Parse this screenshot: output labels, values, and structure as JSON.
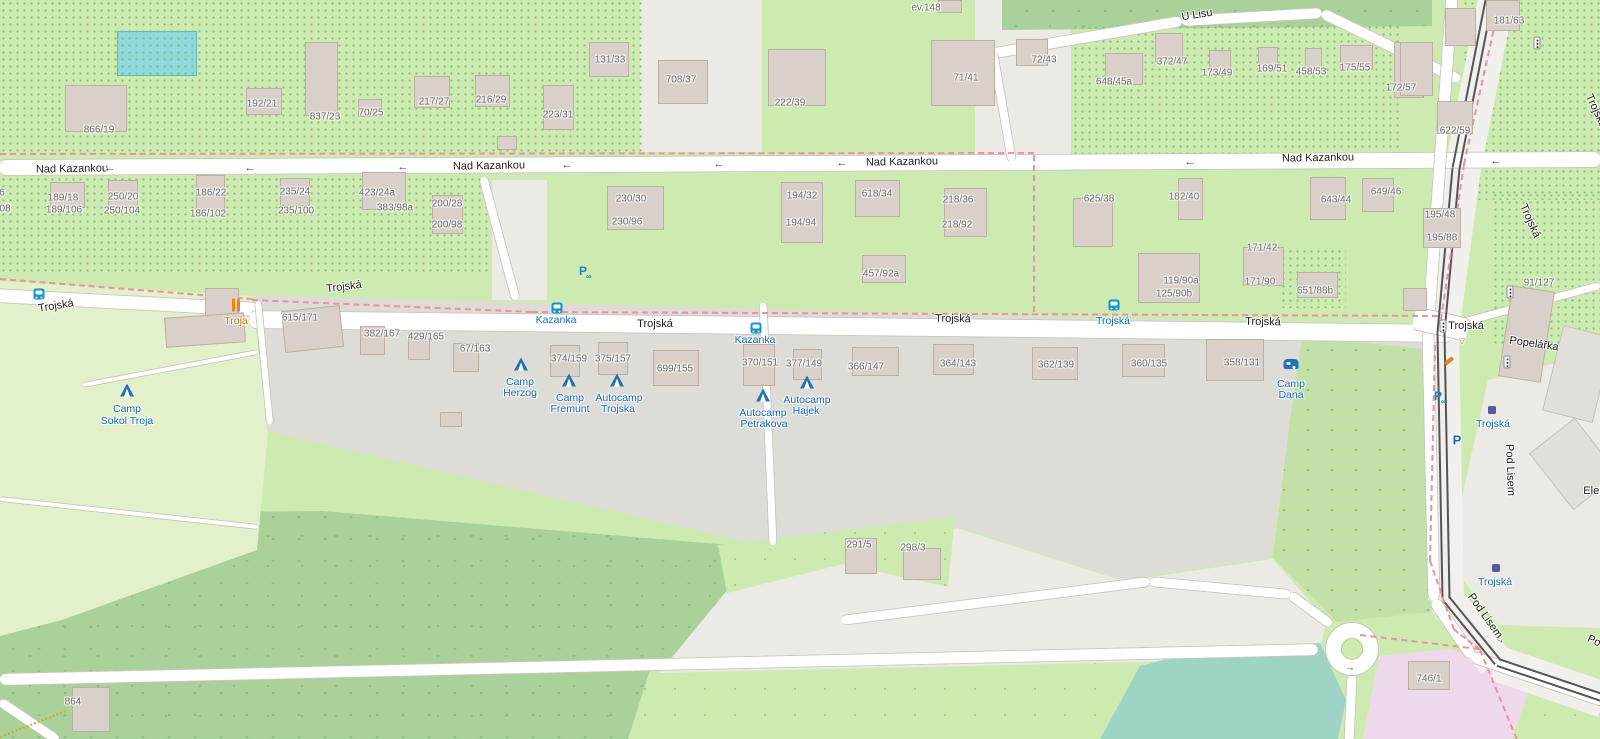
{
  "app": "slippy-map-viewport",
  "colors": {
    "grass": "#cdebb0",
    "camp_area": "#e2f1cb",
    "forest": "#a9d199",
    "scrub": "#c2e0a8",
    "residential_gray": "#dedcd7",
    "paved": "#eceae5",
    "road": "#ffffff",
    "road_casing": "#cac5bb",
    "building": "#d9d0c9",
    "building_border": "#bbb0a2",
    "water": "#9ed4c6",
    "pool": "#8ed8de",
    "pink_zone": "#eed9ec",
    "boundary_dash": "#ef8f9f",
    "path_dotted": "#d9a62e",
    "transit_blue": "#0f70b7",
    "tourism_blue": "#1269c4",
    "restaurant_orange": "#ef8413",
    "tram_line": "#555555",
    "street_label": "#1d1d1d",
    "house_label": "#6b6b6b"
  },
  "street_labels": [
    {
      "text": "Nad Kazankou",
      "x": 72,
      "y": 169,
      "rot": -1
    },
    {
      "text": "Nad Kazankou",
      "x": 489,
      "y": 166,
      "rot": -1
    },
    {
      "text": "Nad Kazankou",
      "x": 902,
      "y": 162,
      "rot": -1
    },
    {
      "text": "Nad Kazankou",
      "x": 1318,
      "y": 158,
      "rot": -1
    },
    {
      "text": "U Lisu",
      "x": 1197,
      "y": 15,
      "rot": -9
    },
    {
      "text": "Trojská",
      "x": 56,
      "y": 306,
      "rot": -9
    },
    {
      "text": "Trojská",
      "x": 344,
      "y": 287,
      "rot": -7
    },
    {
      "text": "Trojská",
      "x": 655,
      "y": 324,
      "rot": 0
    },
    {
      "text": "Trojská",
      "x": 953,
      "y": 319,
      "rot": 1
    },
    {
      "text": "Trojská",
      "x": 1263,
      "y": 322,
      "rot": 1
    },
    {
      "text": "Trojská",
      "x": 1466,
      "y": 326,
      "rot": 0
    },
    {
      "text": "Trojská",
      "x": 1596,
      "y": 111,
      "rot": 65
    },
    {
      "text": "Trojská",
      "x": 1530,
      "y": 221,
      "rot": 66
    },
    {
      "text": "Pod Lisem",
      "x": 1510,
      "y": 470,
      "rot": 88
    },
    {
      "text": "Pod Lisem",
      "x": 1485,
      "y": 616,
      "rot": 55
    },
    {
      "text": "Popelářka",
      "x": 1534,
      "y": 344,
      "rot": 8
    },
    {
      "text": "Elek",
      "x": 1594,
      "y": 491,
      "rot": 0
    },
    {
      "text": "Po",
      "x": 1594,
      "y": 641,
      "rot": 25
    }
  ],
  "house_numbers": [
    {
      "text": "866/19",
      "x": 99,
      "y": 130
    },
    {
      "text": "192/21",
      "x": 262,
      "y": 104
    },
    {
      "text": "837/23",
      "x": 325,
      "y": 117
    },
    {
      "text": "70/25",
      "x": 371,
      "y": 113
    },
    {
      "text": "217/27",
      "x": 434,
      "y": 102
    },
    {
      "text": "216/29",
      "x": 491,
      "y": 100
    },
    {
      "text": "223/31",
      "x": 558,
      "y": 115
    },
    {
      "text": "131/33",
      "x": 610,
      "y": 60
    },
    {
      "text": "708/37",
      "x": 681,
      "y": 80
    },
    {
      "text": "222/39",
      "x": 790,
      "y": 103
    },
    {
      "text": "71/41",
      "x": 966,
      "y": 78
    },
    {
      "text": "ev.148",
      "x": 926,
      "y": 8
    },
    {
      "text": "72/43",
      "x": 1044,
      "y": 60
    },
    {
      "text": "648/45a",
      "x": 1114,
      "y": 82
    },
    {
      "text": "372/47",
      "x": 1172,
      "y": 62
    },
    {
      "text": "173/49",
      "x": 1217,
      "y": 73
    },
    {
      "text": "169/51",
      "x": 1272,
      "y": 69
    },
    {
      "text": "458/53",
      "x": 1311,
      "y": 72
    },
    {
      "text": "175/55",
      "x": 1355,
      "y": 68
    },
    {
      "text": "172/57",
      "x": 1401,
      "y": 88
    },
    {
      "text": "181/63",
      "x": 1509,
      "y": 21
    },
    {
      "text": "622/59",
      "x": 1455,
      "y": 131
    },
    {
      "text": "6",
      "x": 2,
      "y": 193
    },
    {
      "text": "08",
      "x": 5,
      "y": 209
    },
    {
      "text": "189/18",
      "x": 63,
      "y": 198
    },
    {
      "text": "189/106",
      "x": 64,
      "y": 210
    },
    {
      "text": "250/20",
      "x": 123,
      "y": 197
    },
    {
      "text": "250/104",
      "x": 122,
      "y": 211
    },
    {
      "text": "186/22",
      "x": 211,
      "y": 193
    },
    {
      "text": "186/102",
      "x": 208,
      "y": 214
    },
    {
      "text": "235/24",
      "x": 295,
      "y": 192
    },
    {
      "text": "235/100",
      "x": 296,
      "y": 211
    },
    {
      "text": "423/24a",
      "x": 377,
      "y": 193
    },
    {
      "text": "383/98a",
      "x": 395,
      "y": 208
    },
    {
      "text": "200/28",
      "x": 447,
      "y": 204
    },
    {
      "text": "200/98",
      "x": 447,
      "y": 225
    },
    {
      "text": "230/30",
      "x": 631,
      "y": 199
    },
    {
      "text": "230/96",
      "x": 627,
      "y": 222
    },
    {
      "text": "194/32",
      "x": 802,
      "y": 196
    },
    {
      "text": "194/94",
      "x": 801,
      "y": 223
    },
    {
      "text": "618/34",
      "x": 877,
      "y": 194
    },
    {
      "text": "218/36",
      "x": 958,
      "y": 200
    },
    {
      "text": "218/92",
      "x": 957,
      "y": 225
    },
    {
      "text": "457/92a",
      "x": 881,
      "y": 274
    },
    {
      "text": "625/38",
      "x": 1099,
      "y": 199
    },
    {
      "text": "182/40",
      "x": 1184,
      "y": 197
    },
    {
      "text": "643/44",
      "x": 1336,
      "y": 200
    },
    {
      "text": "649/46",
      "x": 1386,
      "y": 192
    },
    {
      "text": "195/48",
      "x": 1440,
      "y": 215
    },
    {
      "text": "195/88",
      "x": 1442,
      "y": 238
    },
    {
      "text": "171/42",
      "x": 1262,
      "y": 248
    },
    {
      "text": "171/90",
      "x": 1260,
      "y": 282
    },
    {
      "text": "119/90a",
      "x": 1181,
      "y": 281
    },
    {
      "text": "125/90b",
      "x": 1174,
      "y": 294
    },
    {
      "text": "651/88b",
      "x": 1315,
      "y": 291
    },
    {
      "text": "91/127",
      "x": 1539,
      "y": 283
    },
    {
      "text": "615/171",
      "x": 300,
      "y": 318
    },
    {
      "text": "382/167",
      "x": 382,
      "y": 334
    },
    {
      "text": "429/165",
      "x": 426,
      "y": 337
    },
    {
      "text": "67/163",
      "x": 475,
      "y": 349
    },
    {
      "text": "374/159",
      "x": 569,
      "y": 359
    },
    {
      "text": "375/157",
      "x": 613,
      "y": 359
    },
    {
      "text": "699/155",
      "x": 675,
      "y": 369
    },
    {
      "text": "370/151",
      "x": 760,
      "y": 363
    },
    {
      "text": "377/149",
      "x": 804,
      "y": 364
    },
    {
      "text": "366/147",
      "x": 866,
      "y": 367
    },
    {
      "text": "364/143",
      "x": 958,
      "y": 364
    },
    {
      "text": "362/139",
      "x": 1056,
      "y": 365
    },
    {
      "text": "360/135",
      "x": 1149,
      "y": 364
    },
    {
      "text": "358/131",
      "x": 1242,
      "y": 363
    },
    {
      "text": "291/5",
      "x": 859,
      "y": 545
    },
    {
      "text": "298/3",
      "x": 913,
      "y": 548
    },
    {
      "text": "746/1",
      "x": 1429,
      "y": 679
    },
    {
      "text": "864",
      "x": 73,
      "y": 702
    }
  ],
  "camps": [
    {
      "name": "Camp Sokol Troja",
      "icon": "tent",
      "icon_x": 127,
      "icon_y": 390,
      "lines": [
        {
          "text": "Camp",
          "x": 127,
          "y": 409
        },
        {
          "text": "Sokol Troja",
          "x": 127,
          "y": 421
        }
      ]
    },
    {
      "name": "Camp Herzog",
      "icon": "tent",
      "icon_x": 521,
      "icon_y": 364,
      "lines": [
        {
          "text": "Camp",
          "x": 520,
          "y": 382
        },
        {
          "text": "Herzog",
          "x": 520,
          "y": 393
        }
      ]
    },
    {
      "name": "Camp Fremunt",
      "icon": "tent",
      "icon_x": 569,
      "icon_y": 380,
      "lines": [
        {
          "text": "Camp",
          "x": 570,
          "y": 398
        },
        {
          "text": "Fremunt",
          "x": 570,
          "y": 409
        }
      ]
    },
    {
      "name": "Autocamp Trojska",
      "icon": "tent",
      "icon_x": 617,
      "icon_y": 380,
      "lines": [
        {
          "text": "Autocamp",
          "x": 619,
          "y": 398
        },
        {
          "text": "Trojska",
          "x": 618,
          "y": 409
        }
      ]
    },
    {
      "name": "Autocamp Petrakova",
      "icon": "tent",
      "icon_x": 763,
      "icon_y": 395,
      "lines": [
        {
          "text": "Autocamp",
          "x": 763,
          "y": 413
        },
        {
          "text": "Petrakova",
          "x": 764,
          "y": 424
        }
      ]
    },
    {
      "name": "Autocamp Hajek",
      "icon": "tent",
      "icon_x": 807,
      "icon_y": 382,
      "lines": [
        {
          "text": "Autocamp",
          "x": 807,
          "y": 400
        },
        {
          "text": "Hajek",
          "x": 806,
          "y": 411
        }
      ]
    },
    {
      "name": "Camp Dana",
      "icon": "caravan",
      "icon_x": 1291,
      "icon_y": 364,
      "lines": [
        {
          "text": "Camp",
          "x": 1291,
          "y": 384
        },
        {
          "text": "Dana",
          "x": 1291,
          "y": 395
        }
      ]
    }
  ],
  "transit_stops": [
    {
      "type": "bus",
      "label": null,
      "icon_x": 39,
      "icon_y": 294,
      "label_x": 0,
      "label_y": 0
    },
    {
      "type": "bus",
      "label": "Kazanka",
      "icon_x": 557,
      "icon_y": 308,
      "label_x": 556,
      "label_y": 320
    },
    {
      "type": "bus",
      "label": "Kazanka",
      "icon_x": 756,
      "icon_y": 328,
      "label_x": 755,
      "label_y": 340
    },
    {
      "type": "bus",
      "label": "Trojská",
      "icon_x": 1114,
      "icon_y": 305,
      "label_x": 1113,
      "label_y": 321
    },
    {
      "type": "tram",
      "label": "Trojská",
      "icon_x": 1492,
      "icon_y": 410,
      "label_x": 1493,
      "label_y": 424
    },
    {
      "type": "tram",
      "label": "Trojská",
      "icon_x": 1496,
      "icon_y": 568,
      "label_x": 1495,
      "label_y": 582
    }
  ],
  "pois": [
    {
      "type": "restaurant",
      "name": "Troja",
      "icon_x": 236,
      "icon_y": 305,
      "label_x": 236,
      "label_y": 321
    }
  ],
  "misc_icons": [
    {
      "type": "parking",
      "x": 1457,
      "y": 440
    },
    {
      "type": "bike-parking",
      "x": 583,
      "y": 271
    },
    {
      "type": "bike-parking",
      "x": 1438,
      "y": 396
    },
    {
      "type": "traffic-signal",
      "x": 1443,
      "y": 326
    },
    {
      "type": "traffic-signal",
      "x": 1510,
      "y": 292
    },
    {
      "type": "traffic-signal",
      "x": 1507,
      "y": 362
    },
    {
      "type": "traffic-signal",
      "x": 1537,
      "y": 43
    },
    {
      "type": "give-way",
      "x": 1462,
      "y": 341
    },
    {
      "type": "bench",
      "x": 1449,
      "y": 361
    }
  ],
  "oneway_arrows": [
    {
      "glyph": "→",
      "x": 1500,
      "y": 640,
      "rot": 25
    },
    {
      "glyph": "→",
      "x": 1350,
      "y": 668,
      "rot": 0
    }
  ],
  "street_arrows": [
    {
      "glyph": "←",
      "x": 110,
      "y": 168
    },
    {
      "glyph": "←",
      "x": 250,
      "y": 168
    },
    {
      "glyph": "←",
      "x": 403,
      "y": 167
    },
    {
      "glyph": "←",
      "x": 567,
      "y": 165
    },
    {
      "glyph": "←",
      "x": 719,
      "y": 164
    },
    {
      "glyph": "←",
      "x": 842,
      "y": 163
    },
    {
      "glyph": "←",
      "x": 1190,
      "y": 162
    },
    {
      "glyph": "←",
      "x": 1496,
      "y": 161
    }
  ],
  "buildings": [
    {
      "x": 65,
      "y": 85,
      "w": 62,
      "h": 47
    },
    {
      "x": 246,
      "y": 88,
      "w": 36,
      "h": 27
    },
    {
      "x": 305,
      "y": 42,
      "w": 33,
      "h": 74
    },
    {
      "x": 358,
      "y": 99,
      "w": 24,
      "h": 18
    },
    {
      "x": 414,
      "y": 76,
      "w": 36,
      "h": 32
    },
    {
      "x": 475,
      "y": 75,
      "w": 35,
      "h": 32
    },
    {
      "x": 497,
      "y": 136,
      "w": 20,
      "h": 14
    },
    {
      "x": 543,
      "y": 85,
      "w": 31,
      "h": 45
    },
    {
      "x": 589,
      "y": 42,
      "w": 40,
      "h": 35
    },
    {
      "x": 658,
      "y": 60,
      "w": 50,
      "h": 44
    },
    {
      "x": 768,
      "y": 49,
      "w": 58,
      "h": 57
    },
    {
      "x": 931,
      "y": 40,
      "w": 64,
      "h": 66
    },
    {
      "x": 938,
      "y": 0,
      "w": 24,
      "h": 13
    },
    {
      "x": 1016,
      "y": 39,
      "w": 32,
      "h": 27
    },
    {
      "x": 1105,
      "y": 53,
      "w": 38,
      "h": 32
    },
    {
      "x": 1155,
      "y": 33,
      "w": 28,
      "h": 29
    },
    {
      "x": 1209,
      "y": 50,
      "w": 22,
      "h": 26
    },
    {
      "x": 1258,
      "y": 47,
      "w": 20,
      "h": 22
    },
    {
      "x": 1305,
      "y": 48,
      "w": 17,
      "h": 23
    },
    {
      "x": 1340,
      "y": 45,
      "w": 33,
      "h": 25
    },
    {
      "x": 1394,
      "y": 42,
      "w": 30,
      "h": 56
    },
    {
      "x": 1486,
      "y": 0,
      "w": 34,
      "h": 31
    },
    {
      "x": 1437,
      "y": 101,
      "w": 36,
      "h": 33
    },
    {
      "x": 1400,
      "y": 42,
      "w": 33,
      "h": 54
    },
    {
      "x": 1445,
      "y": 8,
      "w": 31,
      "h": 38
    },
    {
      "x": 50,
      "y": 182,
      "w": 35,
      "h": 26
    },
    {
      "x": 108,
      "y": 180,
      "w": 30,
      "h": 28
    },
    {
      "x": 196,
      "y": 175,
      "w": 29,
      "h": 35
    },
    {
      "x": 280,
      "y": 178,
      "w": 30,
      "h": 28
    },
    {
      "x": 362,
      "y": 172,
      "w": 44,
      "h": 38
    },
    {
      "x": 432,
      "y": 195,
      "w": 31,
      "h": 39
    },
    {
      "x": 607,
      "y": 186,
      "w": 57,
      "h": 44
    },
    {
      "x": 781,
      "y": 182,
      "w": 42,
      "h": 61
    },
    {
      "x": 855,
      "y": 180,
      "w": 45,
      "h": 37
    },
    {
      "x": 944,
      "y": 188,
      "w": 43,
      "h": 49
    },
    {
      "x": 862,
      "y": 255,
      "w": 44,
      "h": 28
    },
    {
      "x": 1073,
      "y": 198,
      "w": 40,
      "h": 49
    },
    {
      "x": 1178,
      "y": 178,
      "w": 25,
      "h": 42
    },
    {
      "x": 1138,
      "y": 253,
      "w": 62,
      "h": 50
    },
    {
      "x": 1243,
      "y": 247,
      "w": 41,
      "h": 39
    },
    {
      "x": 1297,
      "y": 272,
      "w": 41,
      "h": 26
    },
    {
      "x": 1310,
      "y": 177,
      "w": 36,
      "h": 43
    },
    {
      "x": 1362,
      "y": 178,
      "w": 32,
      "h": 34
    },
    {
      "x": 1423,
      "y": 208,
      "w": 38,
      "h": 40
    },
    {
      "x": 1403,
      "y": 288,
      "w": 24,
      "h": 23
    },
    {
      "x": 283,
      "y": 308,
      "w": 59,
      "h": 42,
      "rot": -6
    },
    {
      "x": 360,
      "y": 326,
      "w": 25,
      "h": 29
    },
    {
      "x": 408,
      "y": 333,
      "w": 22,
      "h": 27
    },
    {
      "x": 453,
      "y": 343,
      "w": 26,
      "h": 29
    },
    {
      "x": 205,
      "y": 288,
      "w": 34,
      "h": 34
    },
    {
      "x": 165,
      "y": 315,
      "w": 80,
      "h": 30,
      "rot": -4
    },
    {
      "x": 550,
      "y": 345,
      "w": 30,
      "h": 32
    },
    {
      "x": 598,
      "y": 342,
      "w": 30,
      "h": 33
    },
    {
      "x": 653,
      "y": 350,
      "w": 46,
      "h": 36
    },
    {
      "x": 743,
      "y": 344,
      "w": 32,
      "h": 42
    },
    {
      "x": 793,
      "y": 349,
      "w": 29,
      "h": 31
    },
    {
      "x": 852,
      "y": 347,
      "w": 47,
      "h": 29
    },
    {
      "x": 933,
      "y": 344,
      "w": 41,
      "h": 31
    },
    {
      "x": 1032,
      "y": 347,
      "w": 46,
      "h": 33
    },
    {
      "x": 1122,
      "y": 344,
      "w": 43,
      "h": 33
    },
    {
      "x": 1206,
      "y": 339,
      "w": 58,
      "h": 42
    },
    {
      "x": 440,
      "y": 412,
      "w": 22,
      "h": 15
    },
    {
      "x": 845,
      "y": 538,
      "w": 32,
      "h": 36
    },
    {
      "x": 903,
      "y": 548,
      "w": 38,
      "h": 32
    },
    {
      "x": 72,
      "y": 687,
      "w": 38,
      "h": 45
    },
    {
      "x": 1408,
      "y": 661,
      "w": 42,
      "h": 29
    },
    {
      "x": 1505,
      "y": 288,
      "w": 43,
      "h": 92,
      "rot": 9
    },
    {
      "x": 1552,
      "y": 330,
      "w": 52,
      "h": 88,
      "rot": 14,
      "v": "gray"
    },
    {
      "x": 1545,
      "y": 428,
      "w": 58,
      "h": 72,
      "rot": -38,
      "v": "gray"
    }
  ]
}
